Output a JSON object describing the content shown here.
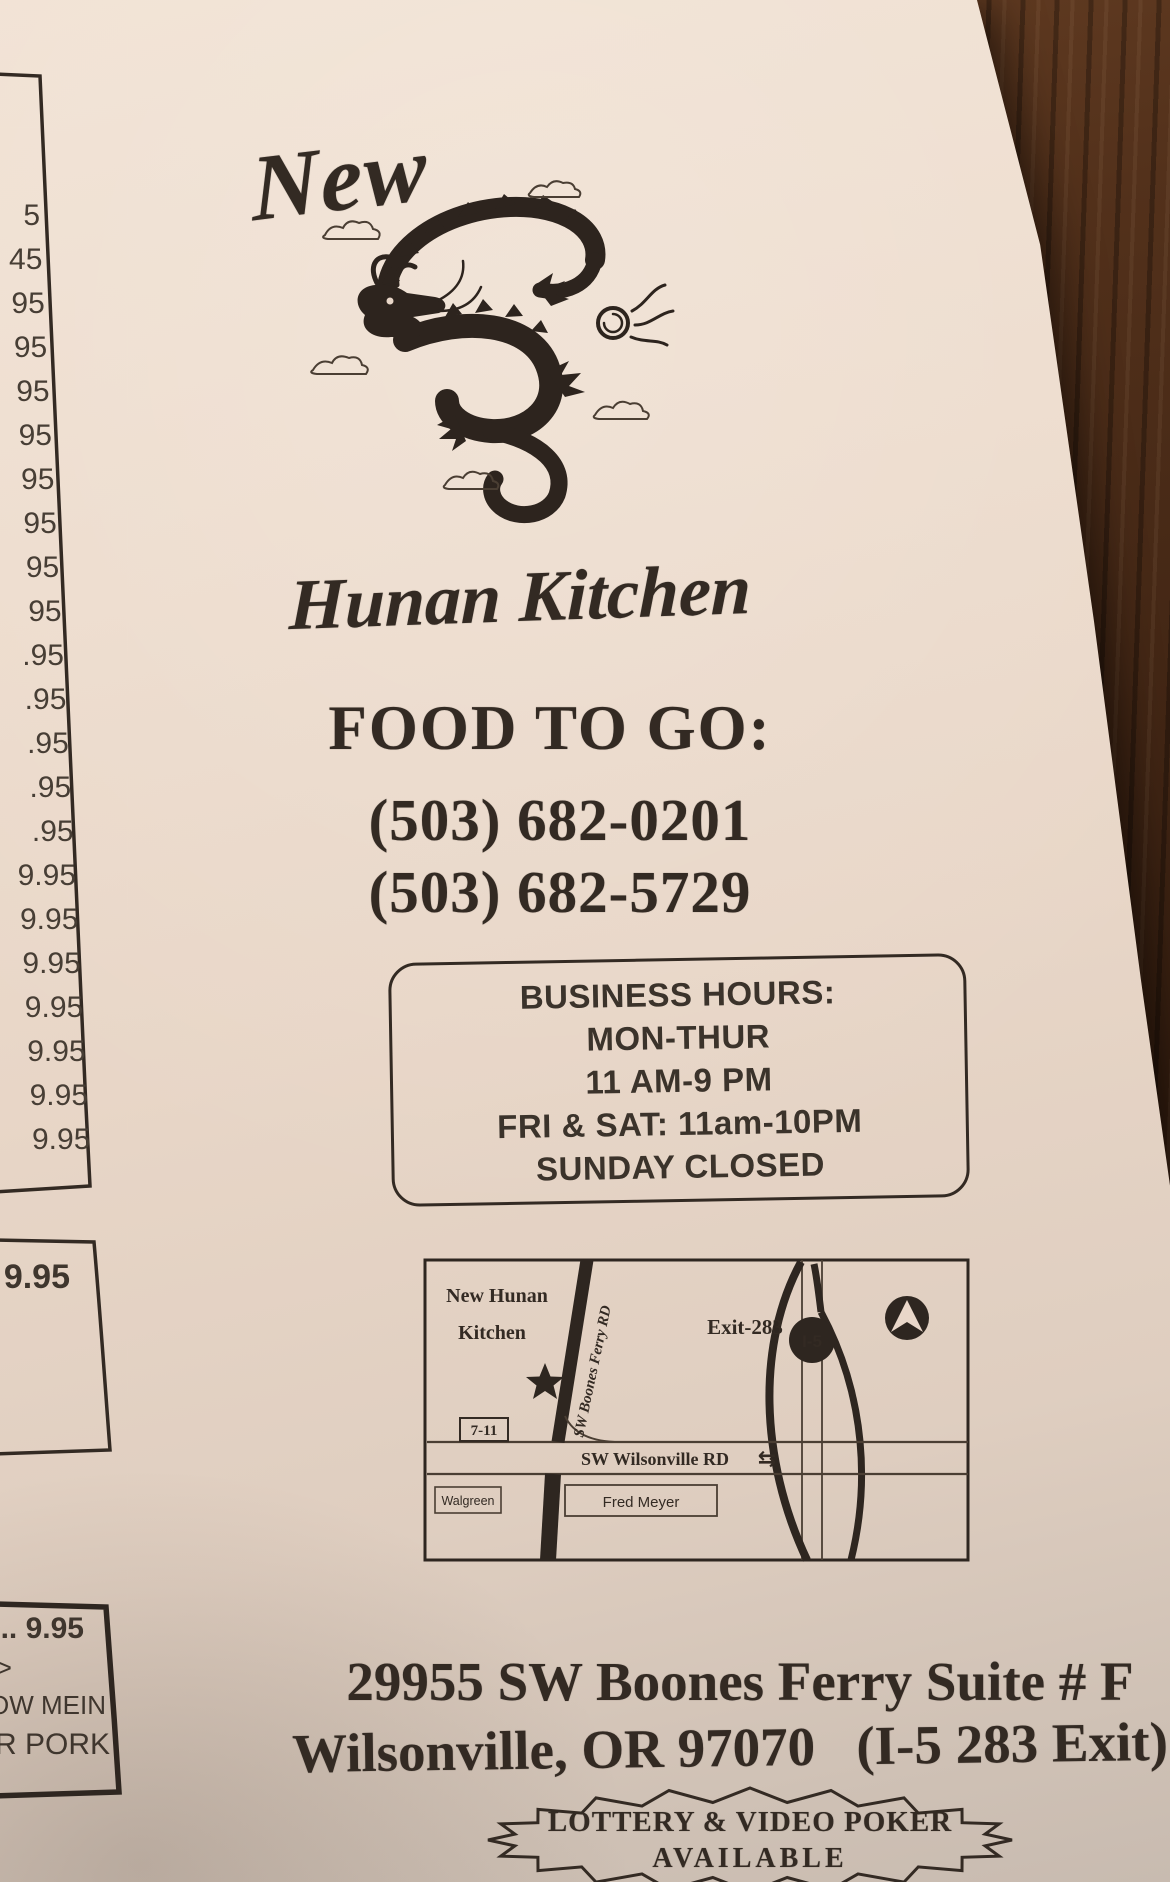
{
  "brand": {
    "prefix": "New",
    "name": "Hunan Kitchen"
  },
  "contact": {
    "heading": "FOOD TO GO:",
    "phone1": "(503) 682-0201",
    "phone2": "(503) 682-5729"
  },
  "hours": {
    "title": "BUSINESS HOURS:",
    "lines": [
      "MON-THUR",
      "11 AM-9 PM",
      "FRI & SAT: 11am-10PM",
      "SUNDAY CLOSED"
    ]
  },
  "map": {
    "business_line1": "New Hunan",
    "business_line2": "Kitchen",
    "road_diagonal": "SW Boones Ferry RD",
    "exit_label": "Exit-283",
    "freeway_badge": "I-5",
    "store_711": "7-11",
    "road_horizontal": "SW Wilsonville RD",
    "arrows": "⇆",
    "store_walgreen": "Walgreen",
    "store_fredmeyer": "Fred Meyer"
  },
  "address": {
    "line1": "29955 SW Boones Ferry Suite # F",
    "line2": "Wilsonville, OR 97070   (I-5 283 Exit)"
  },
  "lottery": {
    "line1": "LOTTERY & VIDEO POKER",
    "line2": "AVAILABLE"
  },
  "left_page": {
    "prices": [
      "5",
      "45",
      "95",
      "95",
      "95",
      "95",
      "95",
      "95",
      "95",
      "95",
      ".95",
      ".95",
      ".95",
      ".95",
      ".95",
      "9.95",
      "9.95",
      "9.95",
      "9.95",
      "9.95",
      "9.95",
      "9.95"
    ],
    "box2_price": "9.95",
    "box3_line1": ".. 9.95",
    "box3_line2": ">",
    "box3_line3": "HOW MEIN",
    "box3_line4": "R PORK"
  },
  "colors": {
    "paper": "#e9d7c9",
    "ink": "#332a23",
    "wood": "#3c2212"
  }
}
